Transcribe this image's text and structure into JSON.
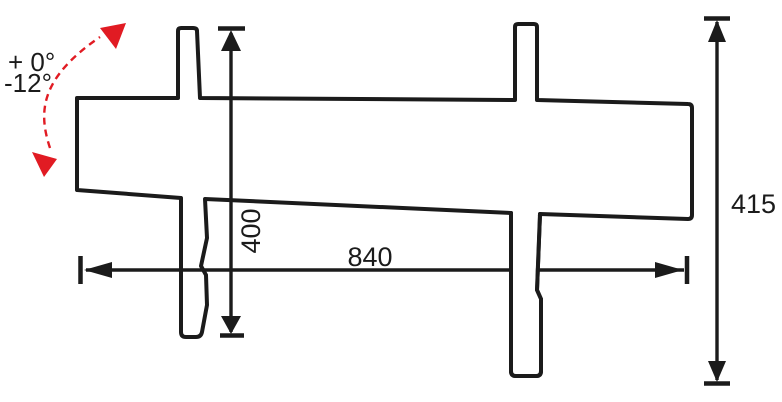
{
  "drawing": {
    "title": "mount-side-profile-dimension-drawing",
    "dimensions": [
      {
        "id": "width",
        "label": "840",
        "orientation": "horizontal"
      },
      {
        "id": "vesa-height",
        "label": "400",
        "orientation": "vertical"
      },
      {
        "id": "overall-height",
        "label": "415",
        "orientation": "vertical"
      }
    ],
    "tilt_annotation": {
      "max_up": "+ 0°",
      "max_down": "-12°"
    },
    "colors": {
      "line": "#1b1b1b",
      "accent": "#e11b23",
      "background": "#ffffff"
    }
  }
}
